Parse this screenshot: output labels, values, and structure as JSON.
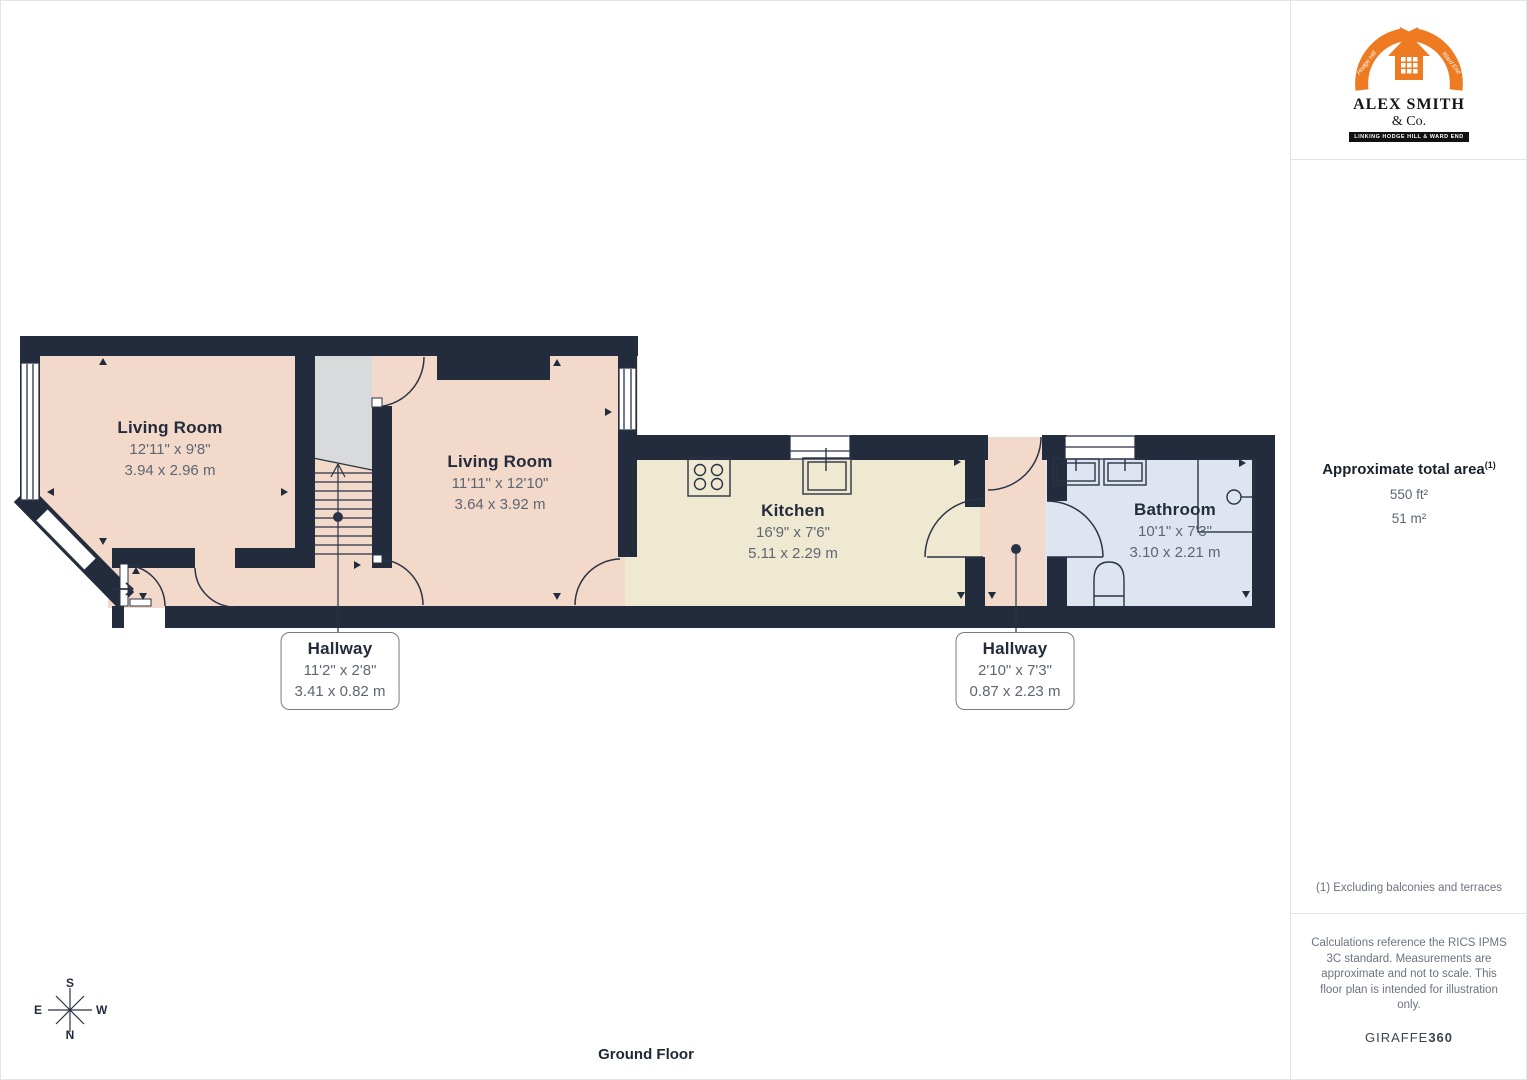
{
  "logo": {
    "company_line1": "ALEX SMITH",
    "company_line2": "& Co.",
    "banner": "LINKING HODGE HILL & WARD END",
    "ribbon_left": "Hodge Hill",
    "ribbon_right": "Ward End"
  },
  "sidebar": {
    "area_title": "Approximate total area",
    "area_title_sup": "(1)",
    "area_ft": "550 ft²",
    "area_m": "51 m²",
    "footnote": "(1) Excluding balconies and terraces",
    "disclaimer": "Calculations reference the RICS IPMS 3C standard. Measurements are approximate and not to scale. This floor plan is intended for illustration only.",
    "brand_normal": "GIRAFFE",
    "brand_bold": "360"
  },
  "plan": {
    "floor_label": "Ground Floor",
    "compass": {
      "n": "N",
      "s": "S",
      "e": "E",
      "w": "W"
    },
    "rooms": [
      {
        "name": "Living Room",
        "imperial": "12'11\" x 9'8\"",
        "metric": "3.94 x 2.96 m"
      },
      {
        "name": "Living Room",
        "imperial": "11'11\" x 12'10\"",
        "metric": "3.64 x 3.92 m"
      },
      {
        "name": "Kitchen",
        "imperial": "16'9\" x 7'6\"",
        "metric": "5.11 x 2.29 m"
      },
      {
        "name": "Bathroom",
        "imperial": "10'1\" x 7'3\"",
        "metric": "3.10 x 2.21 m"
      },
      {
        "name": "Hallway",
        "imperial": "11'2\" x 2'8\"",
        "metric": "3.41 x 0.82 m"
      },
      {
        "name": "Hallway",
        "imperial": "2'10\" x 7'3\"",
        "metric": "0.87 x 2.23 m"
      }
    ]
  },
  "colors": {
    "wall": "#232c3d",
    "line": "#2a3346",
    "room_pink": "#f3d9ca",
    "room_cream": "#f0e9d2",
    "room_blue": "#dfe5f0",
    "stairs_grey": "#d8dadc",
    "window_white": "#ffffff",
    "logo_orange": "#ee7b22"
  }
}
